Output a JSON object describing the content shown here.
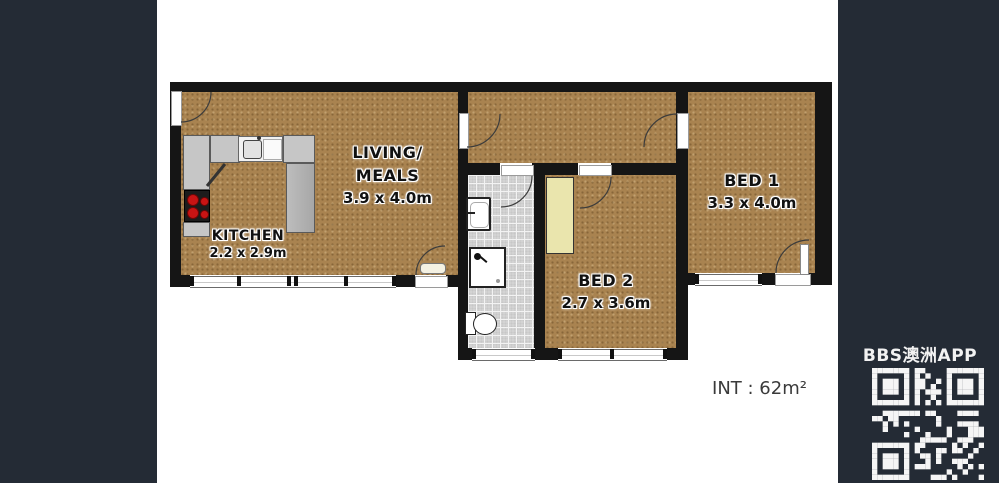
{
  "colors": {
    "background": "#242b35",
    "paper": "#ffffff",
    "floor": "#a98350",
    "wall": "#151515",
    "bath_tile": "#d3d3d3",
    "wardrobe": "#eae5ad"
  },
  "rooms": {
    "living": {
      "name_line1": "LIVING/",
      "name_line2": "MEALS",
      "dims": "3.9 x 4.0m"
    },
    "kitchen": {
      "name": "KITCHEN",
      "dims": "2.2 x 2.9m"
    },
    "bed1": {
      "name": "BED 1",
      "dims": "3.3 x 4.0m"
    },
    "bed2": {
      "name": "BED 2",
      "dims": "2.7 x 3.6m"
    }
  },
  "summary": {
    "internal_area": "INT : 62m²"
  },
  "fixtures": {
    "kitchen": [
      "kitchen-sink",
      "stove-hotplates",
      "counter"
    ],
    "bathroom": [
      "basin",
      "shower",
      "toilet"
    ],
    "bed2": [
      "wardrobe"
    ]
  },
  "watermark": {
    "app_name": "BBS澳洲APP",
    "qr": "qr-code"
  }
}
